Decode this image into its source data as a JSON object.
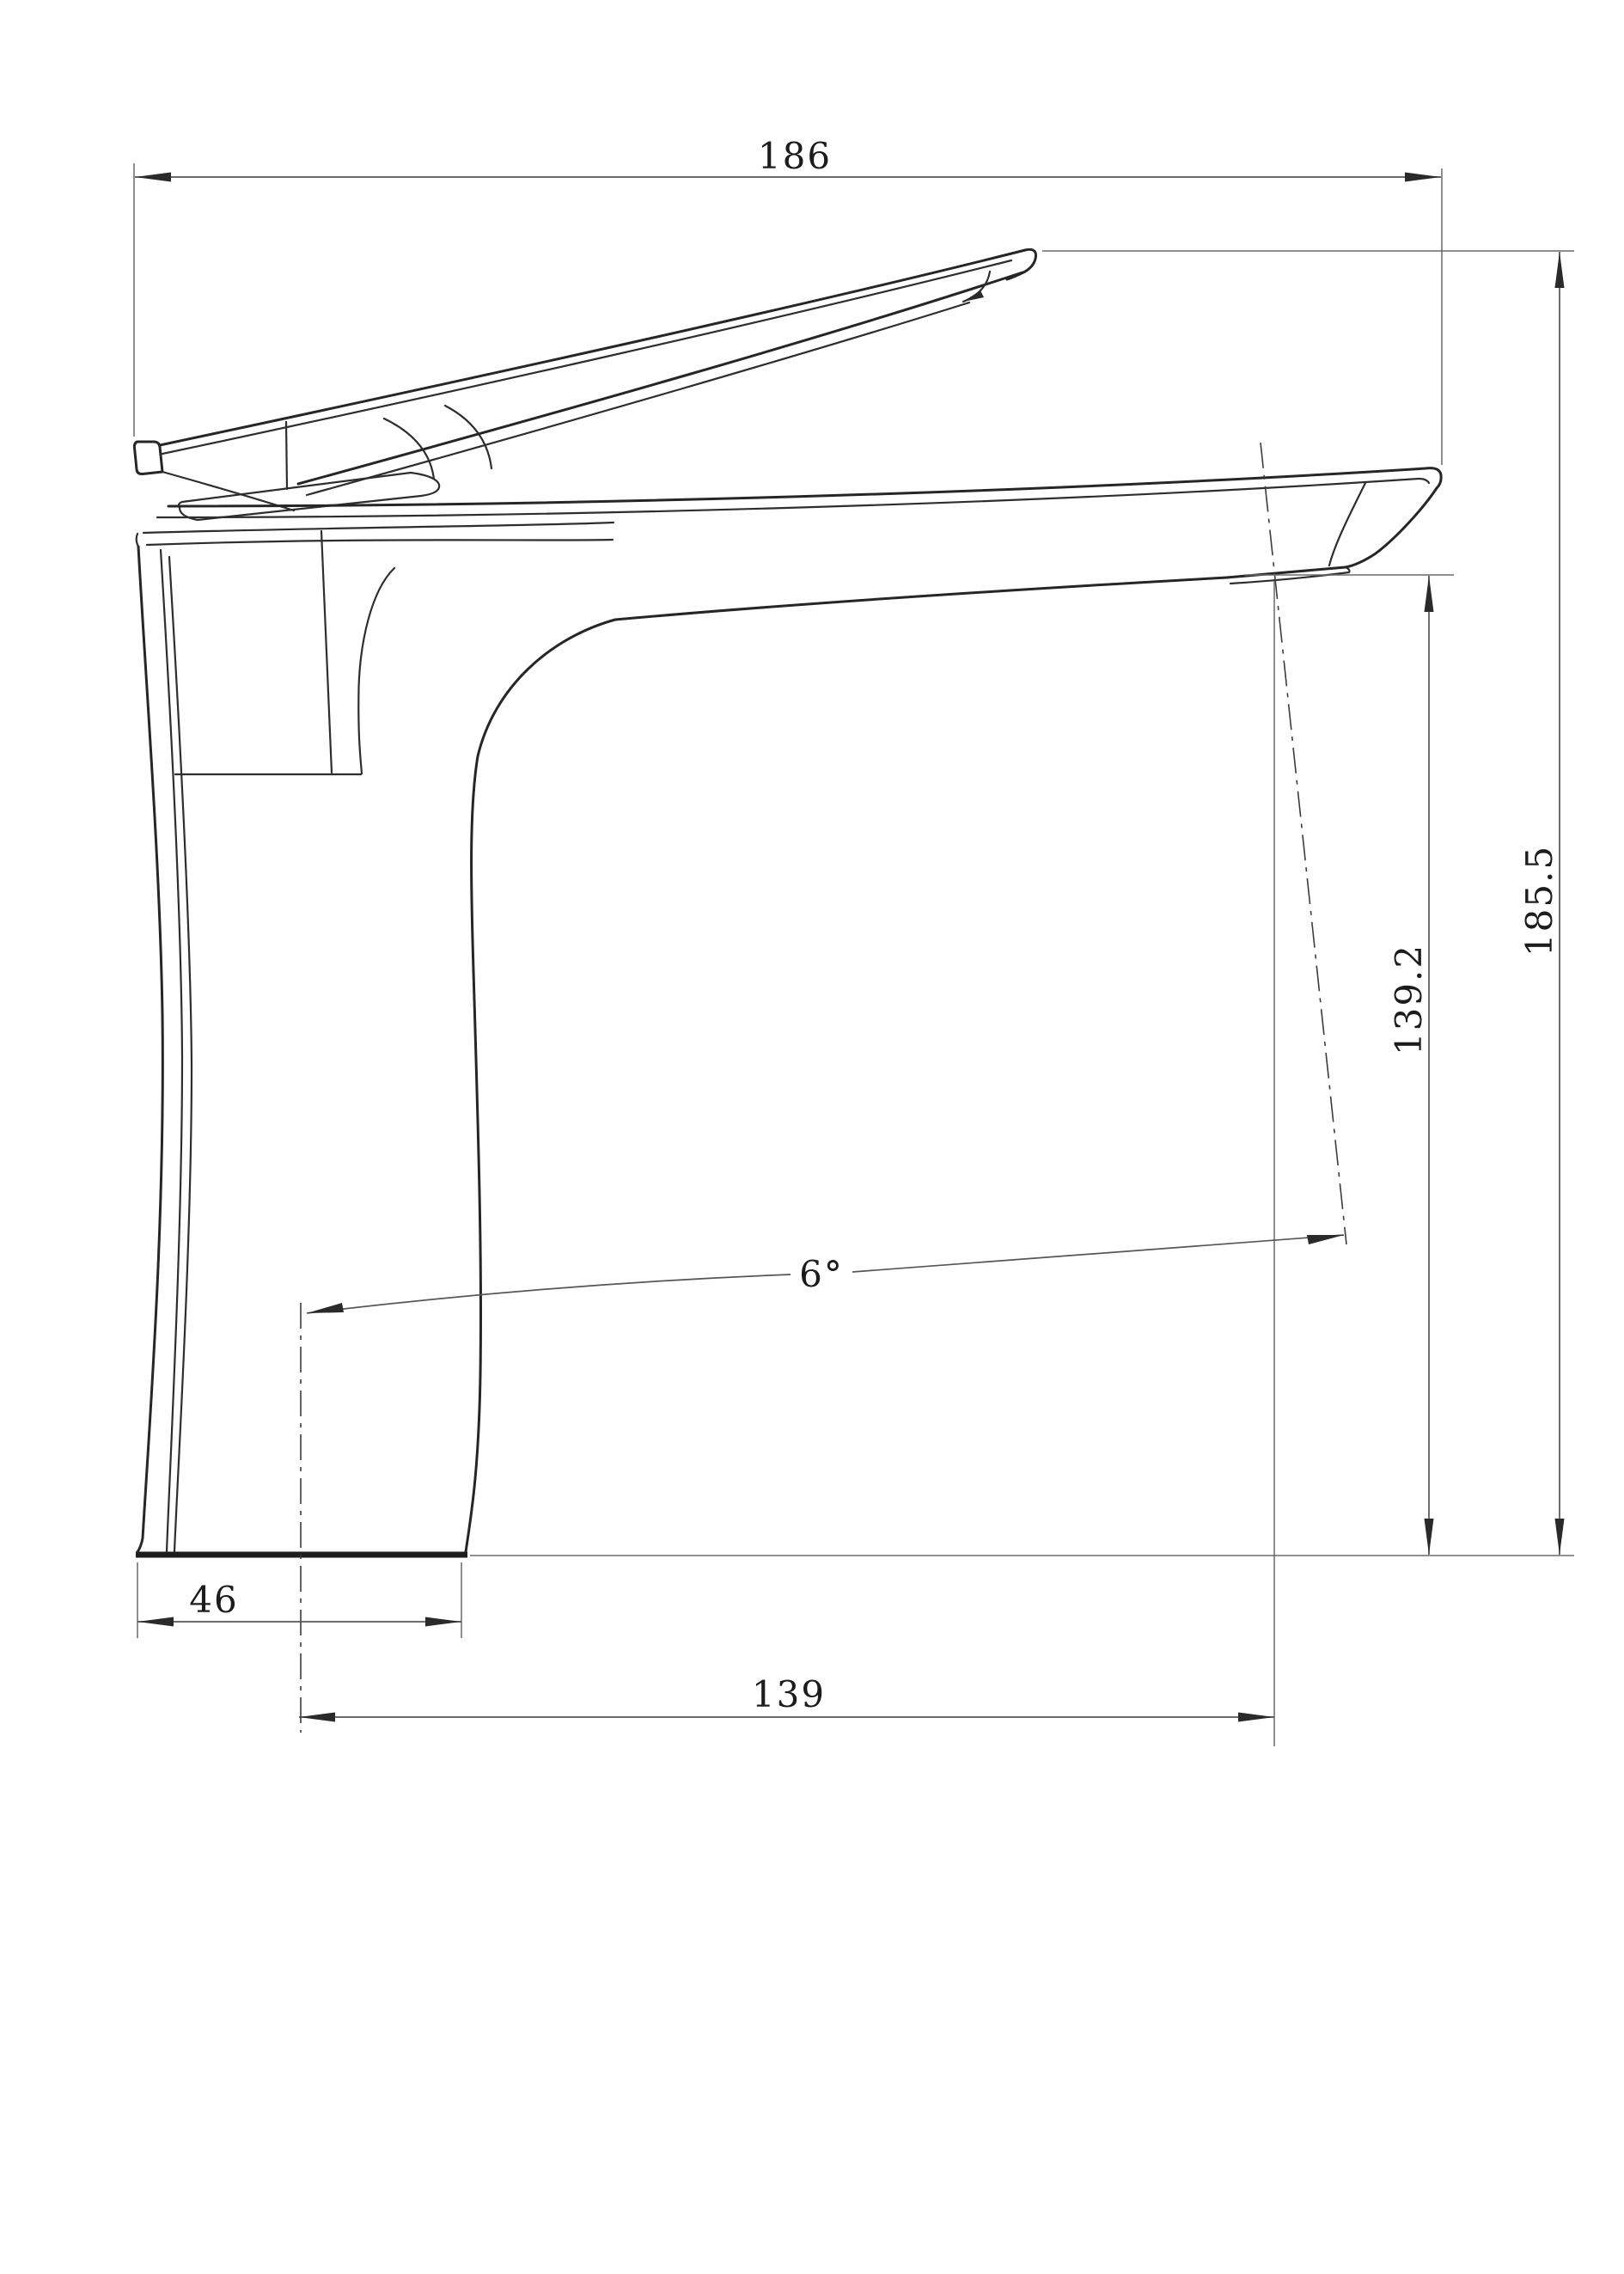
{
  "drawing": {
    "type": "technical-drawing",
    "subject": "single-lever basin faucet, side elevation with dimensions",
    "units_implied": "mm",
    "dimensions": {
      "overall_width": "186",
      "overall_height": "185.5",
      "spout_outlet_height": "139.2",
      "spout_reach": "139",
      "base_depth": "46",
      "spout_angle": "6°"
    },
    "colors": {
      "background": "#ffffff",
      "outline": "#262626",
      "dimension_lines": "#565656",
      "text": "#1c1c1c"
    }
  }
}
